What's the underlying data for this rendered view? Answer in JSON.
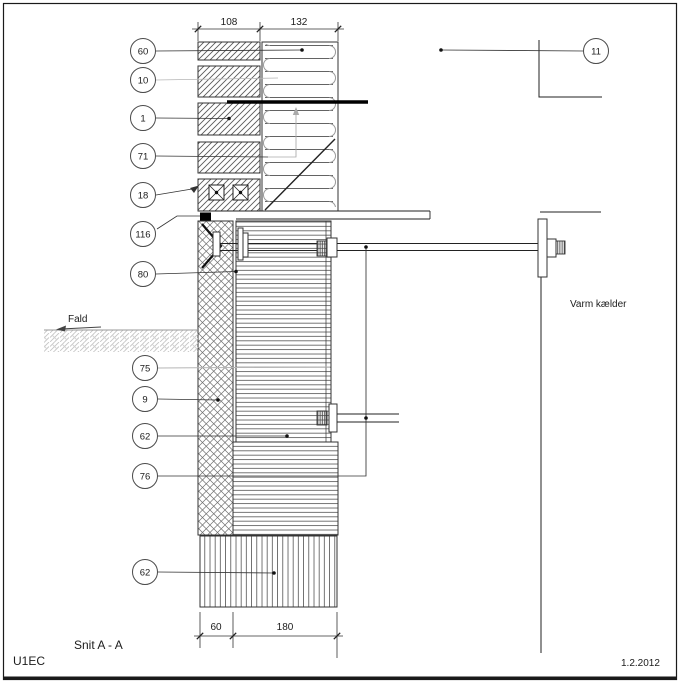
{
  "title_block": {
    "section_label": "Snit A - A",
    "sheet_code": "U1EC",
    "date": "1.2.2012"
  },
  "annotations": {
    "room_label": "Varm kælder",
    "slope_label": "Fald"
  },
  "dimensions": {
    "wall_top": {
      "left": "108",
      "right": "132"
    },
    "footing_bottom": {
      "left": "60",
      "right": "180"
    }
  },
  "callouts": {
    "c60": "60",
    "c10": "10",
    "c1": "1",
    "c71": "71",
    "c18": "18",
    "c116": "116",
    "c80": "80",
    "c75": "75",
    "c9": "9",
    "c62_wall": "62",
    "c76": "76",
    "c62_footing": "62",
    "c11": "11"
  },
  "colors": {
    "line": "#222222",
    "leader_gray": "#b0b0b0",
    "membrane": "#000000",
    "ground_hatch": "#c6c6c6"
  }
}
